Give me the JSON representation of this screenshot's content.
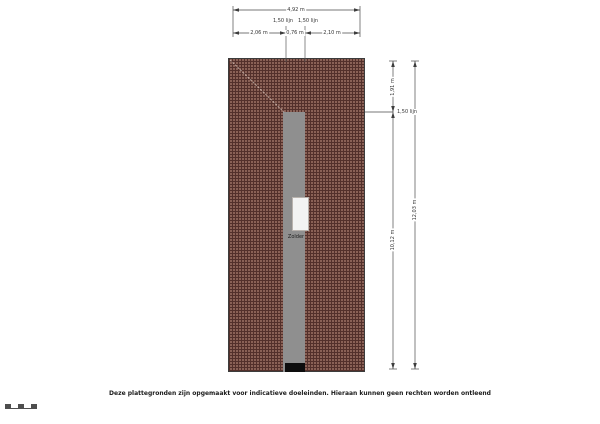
{
  "plan": {
    "room_label": "Zolder",
    "colors": {
      "roof_fill": "#8a6156",
      "roof_grid": "#53302b",
      "floor_strip": "#8f8f8f",
      "stair_opening": "#f3f3f3",
      "entry_marker": "#0d0d0d"
    }
  },
  "dimensions": {
    "top_overall": "4,92 m",
    "top_lijn_left": "1,50 lijn",
    "top_lijn_right": "1,50 lijn",
    "top_seg_left": "2,06 m",
    "top_seg_mid": "0,76 m",
    "top_seg_right": "2,10 m",
    "right_upper": "1,91 m",
    "right_lower": "10,12 m",
    "right_overall": "12,03 m",
    "right_lijn": "1,50 lijn"
  },
  "footer": {
    "disclaimer": "Deze plattegronden zijn opgemaakt voor indicatieve doeleinden. Hieraan kunnen geen rechten worden ontleend"
  }
}
